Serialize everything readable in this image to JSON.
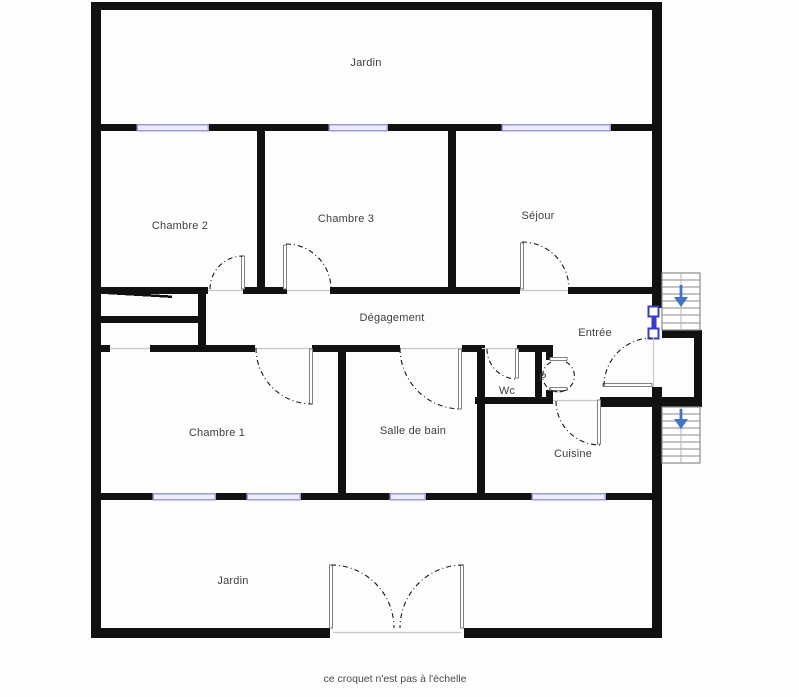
{
  "plan": {
    "caption": "ce croquet n'est pas à l'échelle",
    "rooms": {
      "jardin_top": {
        "label": "Jardin"
      },
      "chambre2": {
        "label": "Chambre 2"
      },
      "chambre3": {
        "label": "Chambre 3"
      },
      "sejour": {
        "label": "Séjour"
      },
      "degagement": {
        "label": "Dégagement"
      },
      "entree": {
        "label": "Entrée"
      },
      "chambre1": {
        "label": "Chambre 1"
      },
      "salle_de_bain": {
        "label": "Salle de bain"
      },
      "wc": {
        "label": "Wc"
      },
      "placard": {
        "label": "P"
      },
      "cuisine": {
        "label": "Cuisine"
      },
      "jardin_bottom": {
        "label": "Jardin"
      }
    },
    "stairs": {
      "upper_arrow": "down",
      "lower_arrow": "down"
    },
    "colors": {
      "wall": "#111111",
      "window_frame": "#9b9bdc",
      "window_fill": "#ededf9",
      "front_door_blue": "#3a3ac8",
      "stairs_arrow_blue": "#4472c4",
      "door_leaf_gray": "#808080",
      "stair_gray": "#8a8a8a",
      "arc_black": "#1a1a1a",
      "threshold_gray": "#c8c8cc",
      "label_gray": "#3f3f3f"
    }
  }
}
